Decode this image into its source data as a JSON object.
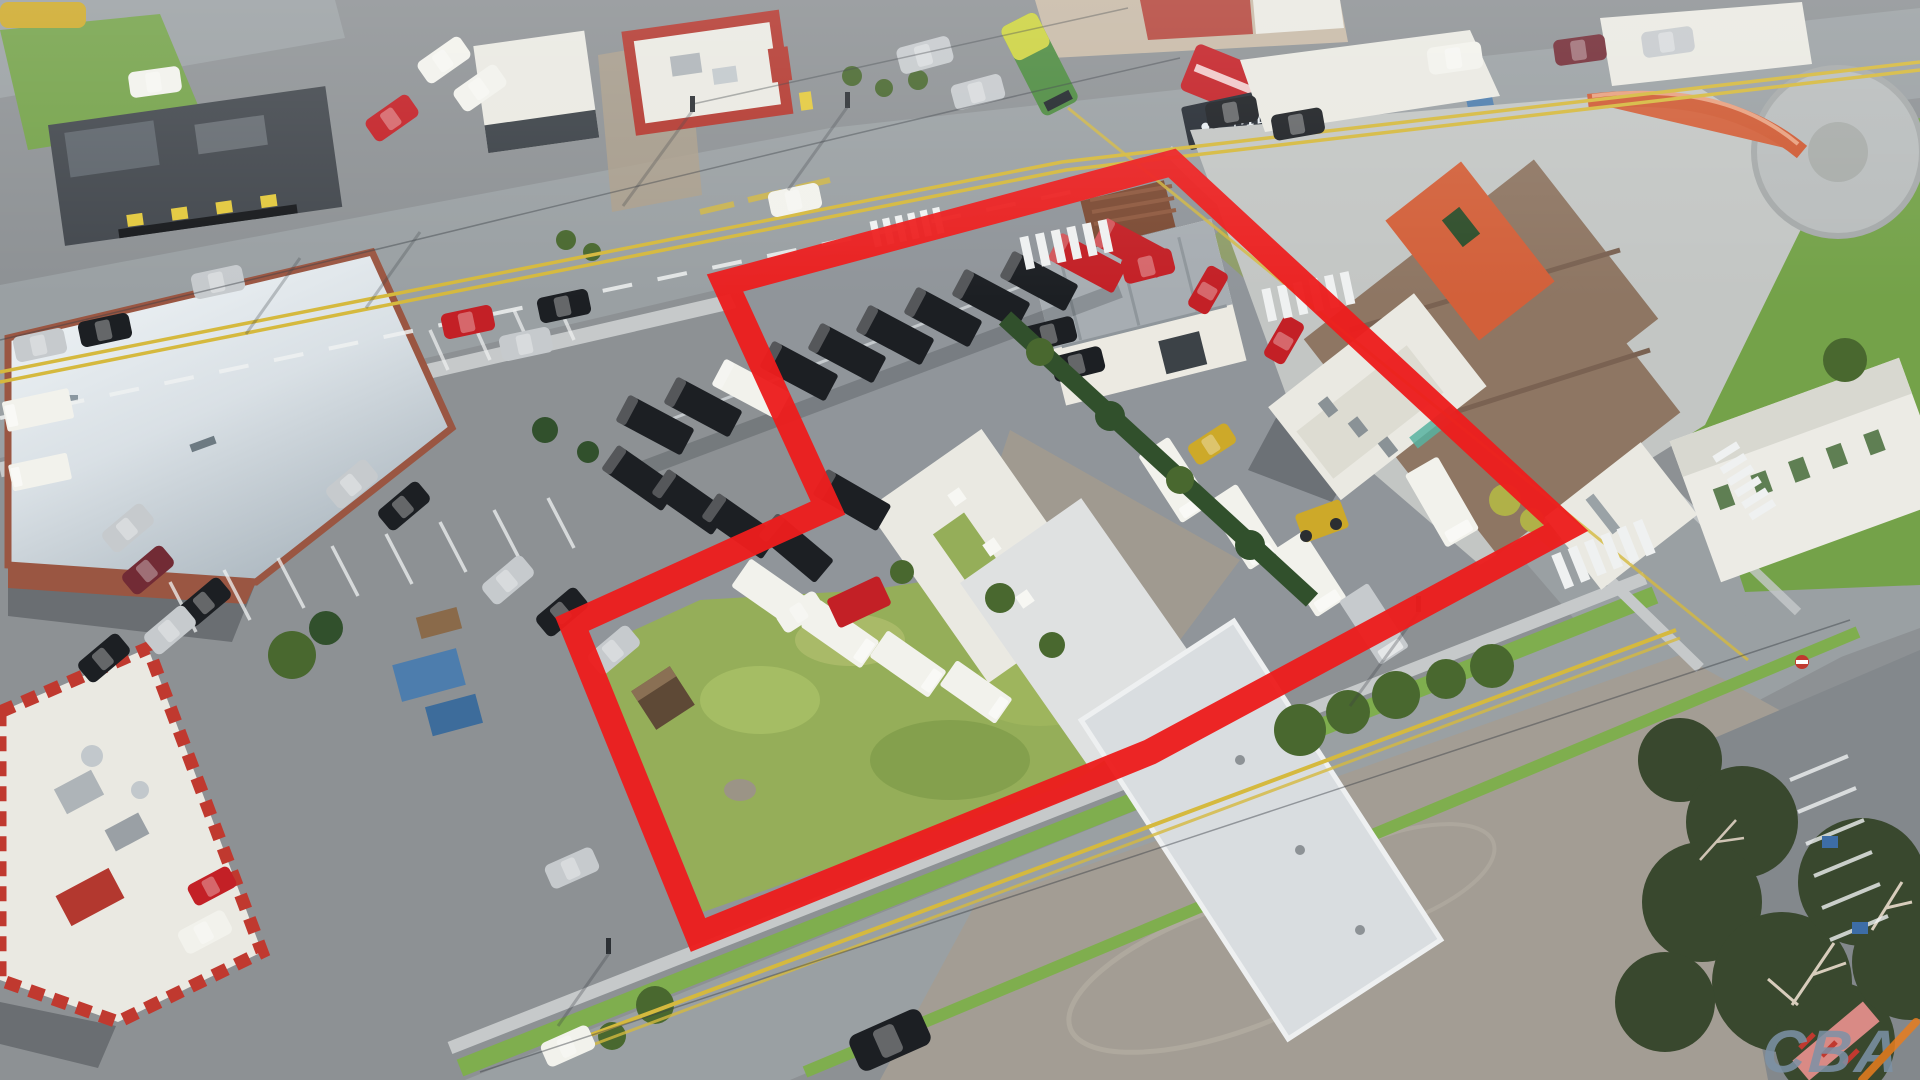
{
  "image": {
    "kind": "aerial-drone-photograph",
    "subject": "commercial property outlined in red (truck and trailer sales lot with vacant grass parcel)"
  },
  "boundary": {
    "color": "#ec1d1d",
    "stroke_width": 26,
    "points": "725,283 1172,163 1566,528 1150,752 698,935 572,624 828,508"
  },
  "signs": {
    "mill_creek_wall": "Mill Creek"
  },
  "watermark": {
    "text": "CBA",
    "letters_color": "#7d92a7",
    "swoosh_color": "#e87d1e"
  },
  "palette": {
    "boundary": "#ec1d1d",
    "road": "#9aa0a3",
    "road-dark": "#83888c",
    "lot": "#8d9194",
    "sidewalk": "#c6c9ca",
    "concrete": "#c3c6c4",
    "grass": "#74a249",
    "grass-verge": "#7fae4e",
    "vacant": "#95ae59",
    "gravel": "#a39d94",
    "white-roof": "#eae9e2",
    "dark-roof": "#42474d",
    "brick": "#9a5642",
    "silver-roof": "#d7dee3",
    "church-roof": "#8e7663",
    "orange": "#d2603a",
    "wall-dark": "#252b33",
    "hedge": "#31502c",
    "tree": "#49682f",
    "tree-olive": "#39482e",
    "tree-yellow": "#b0b148",
    "v-black": "#1c1f23",
    "v-white": "#f2f2ec",
    "v-red": "#c32026",
    "v-silver": "#c6cacd",
    "v-blue": "#3d6da6",
    "v-maroon": "#722b35",
    "v-yellow": "#cda929",
    "bus-green": "#4c8a3f",
    "bus-yellow": "#ccd23e",
    "stripe": "#eff1f1",
    "lane-yellow": "#d5b93e",
    "shadow": "rgba(25,30,36,0.30)",
    "red-stripe": "#c0392f",
    "blue-bin": "#4d7dad",
    "shed": "#5e4936",
    "dirt": "#ac9f8a",
    "wm-blue": "#7d92a7",
    "wm-orange": "#e87d1e"
  }
}
